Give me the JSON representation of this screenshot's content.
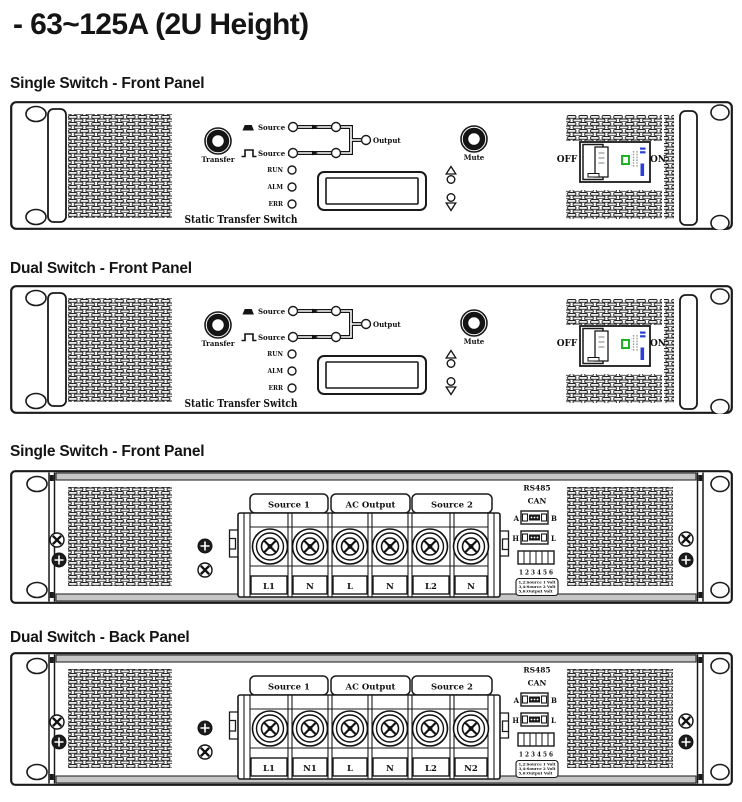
{
  "page": {
    "title": "- 63~125A (2U Height)"
  },
  "sections": {
    "s1": "Single Switch - Front Panel",
    "s2": "Dual Switch - Front Panel",
    "s3": "Single Switch - Front Panel",
    "s4": "Dual Switch - Back Panel"
  },
  "front": {
    "transfer": "Transfer",
    "mute": "Mute",
    "source1": "Source 1",
    "source2": "Source 2",
    "output": "Output",
    "led_run": "RUN",
    "led_alm": "ALM",
    "led_err": "ERR",
    "name": "Static Transfer Switch",
    "off": "OFF",
    "on": "ON"
  },
  "back": {
    "group1": "Source 1",
    "group2": "AC Output",
    "group3": "Source 2",
    "rs485": "RS485",
    "can": "CAN",
    "a": "A",
    "b": "B",
    "h": "H",
    "l": "L",
    "dip": "1 2 3 4 5 6",
    "legend1": "1,2:Source 1 Volt",
    "legend2": "3,4:Source 2 Volt",
    "legend3": "5,6:Output Volt",
    "single": {
      "t1": "L1",
      "t2": "N",
      "t3": "L",
      "t4": "N",
      "t5": "L2",
      "t6": "N"
    },
    "dual": {
      "t1": "L1",
      "t2": "N1",
      "t3": "L",
      "t4": "N",
      "t5": "L2",
      "t6": "N2"
    }
  },
  "colors": {
    "indicator_green": "#1db32a",
    "indicator_blue": "#2b3fd6",
    "line": "#1a1a1a"
  }
}
